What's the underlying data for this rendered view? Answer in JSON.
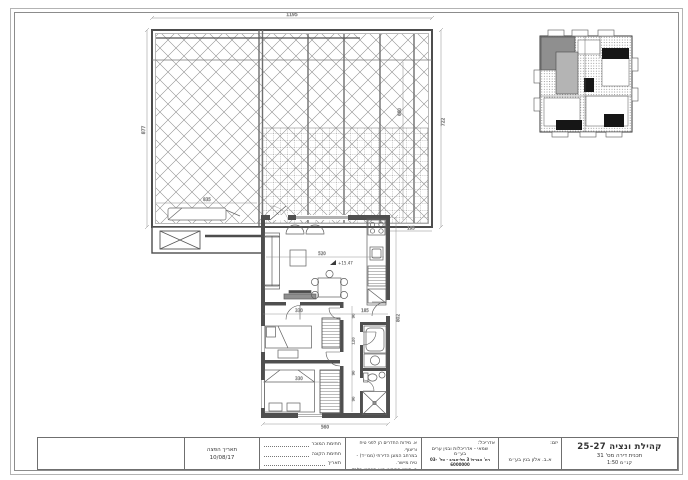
{
  "title_block": {
    "project_title": "קהילת ונציה 25-27",
    "drawing_title": "תכנית דירה מס' 31",
    "scale": "קנ״מ 1:50",
    "developer_label": "יזם:",
    "developer_name": "א.ב. אלון בנין בע״מ",
    "architect_label": "אדריכל:",
    "architect_name": "שמאי - אדריכלות ובנין ערים בע״מ",
    "architect_contact": "רח' הברזל 3 תל-אביב · טל' 03-6000000",
    "notes_line1": "א. מידות החדרים הן לפני טיח וריצוף.",
    "notes_line2": "במרחב המוגן הדירתי (ממ״ד) - טיח מיישר.",
    "notes_line3": "ב. סימון הריהוט הוא סכמטי בלבד ולא מחייב.",
    "sign_seller_label": "חתימת המוכר",
    "sign_buyer_label": "חתימת הקונה",
    "sign_date_label": "תאריך",
    "issue_date_label": "תאריך הפצה",
    "issue_date": "10/08/17"
  },
  "dimensions": {
    "terrace": {
      "width_top": "1195",
      "height_left": "877",
      "height_right": "722",
      "inner_width": "835",
      "inner_height": "660",
      "right_offset": "195"
    },
    "apartment": {
      "width_bottom": "560",
      "height_right": "802",
      "living_width": "520",
      "bed1_width": "330",
      "bed2_width": "330",
      "hall_width": "185",
      "corr_a": "90",
      "corr_b": "120",
      "corr_c": "90",
      "corr_d": "90"
    }
  },
  "levels": {
    "living_level": "+15.47"
  }
}
